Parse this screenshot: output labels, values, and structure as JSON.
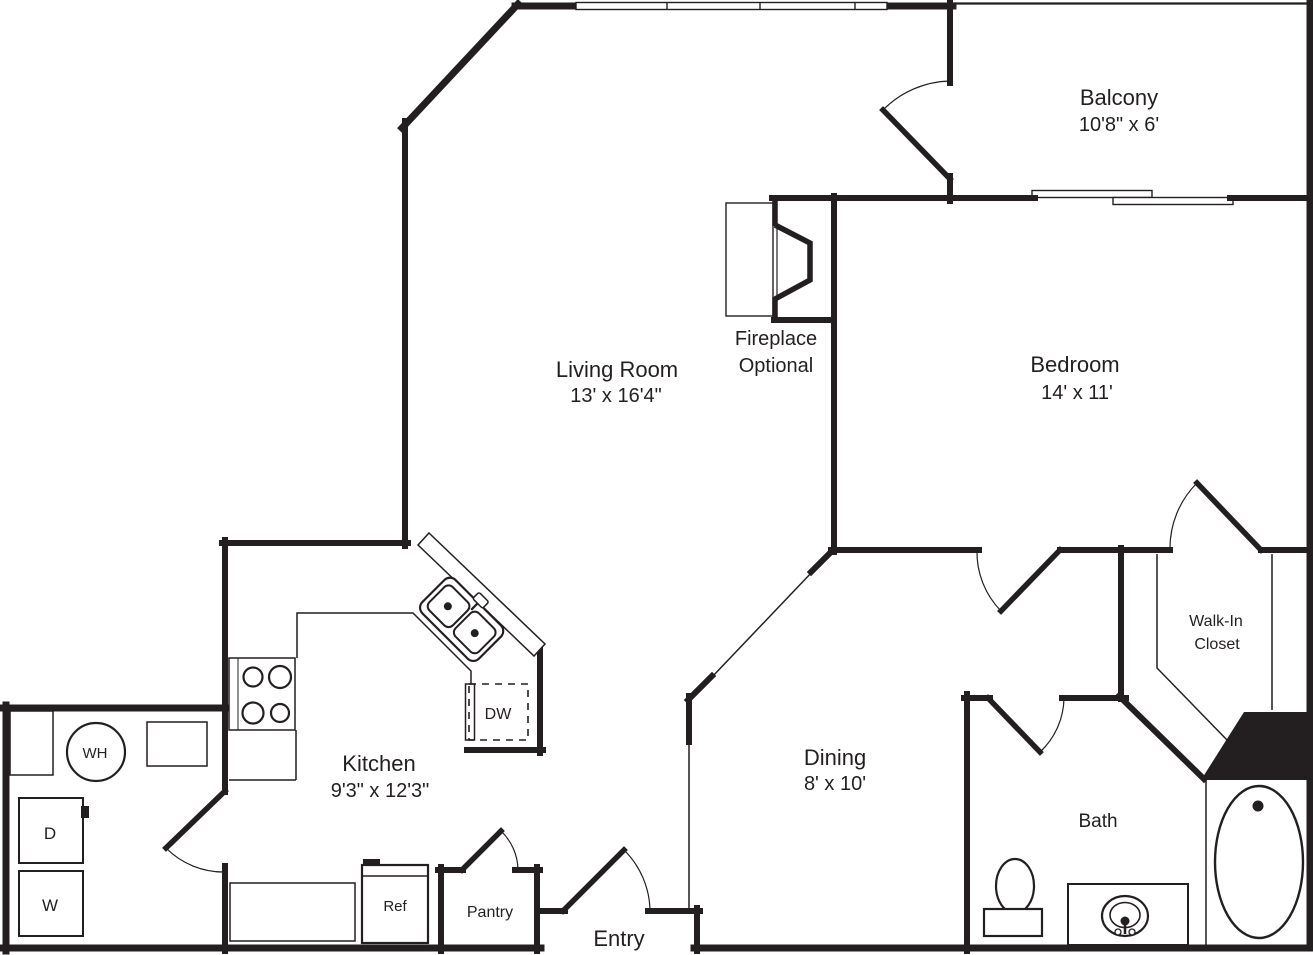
{
  "plan": {
    "type": "apartment-floor-plan",
    "colors": {
      "wall": "#231f20",
      "background": "#ffffff"
    },
    "rooms": {
      "balcony": {
        "name": "Balcony",
        "dims": "10'8\" x 6'"
      },
      "living": {
        "name": "Living Room",
        "dims": "13' x 16'4\""
      },
      "bedroom": {
        "name": "Bedroom",
        "dims": "14' x 11'"
      },
      "kitchen": {
        "name": "Kitchen",
        "dims": "9'3\" x 12'3\""
      },
      "dining": {
        "name": "Dining",
        "dims": "8' x 10'"
      },
      "bath": {
        "name": "Bath"
      },
      "walk_in_closet": {
        "line1": "Walk-In",
        "line2": "Closet"
      },
      "entry": {
        "name": "Entry"
      },
      "pantry": {
        "name": "Pantry"
      },
      "fireplace": {
        "line1": "Fireplace",
        "line2": "Optional"
      }
    },
    "fixtures": {
      "water_heater": "WH",
      "dryer": "D",
      "washer": "W",
      "refrigerator": "Ref",
      "dishwasher": "DW"
    }
  }
}
